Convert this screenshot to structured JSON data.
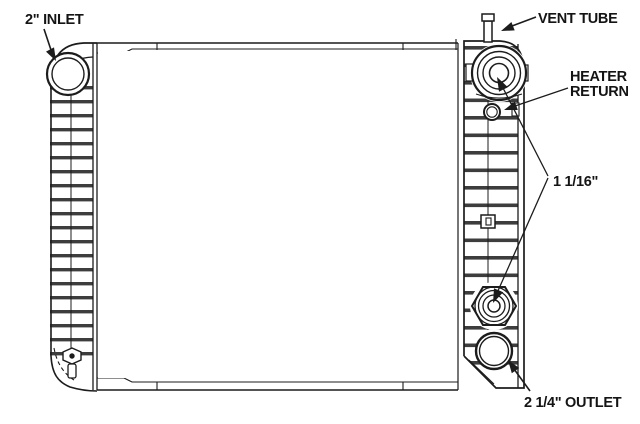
{
  "diagram": {
    "type": "radiator-technical-drawing",
    "labels": {
      "inlet": "2\" INLET",
      "vent_tube": "VENT TUBE",
      "heater_return_line1": "HEATER",
      "heater_return_line2": "RETURN",
      "fitting_size": "1 1/16\"",
      "outlet": "2 1/4\" OUTLET"
    },
    "colors": {
      "ink": "#1c1c1c",
      "background": "#ffffff",
      "rib_band": "#3d3d3d"
    }
  }
}
